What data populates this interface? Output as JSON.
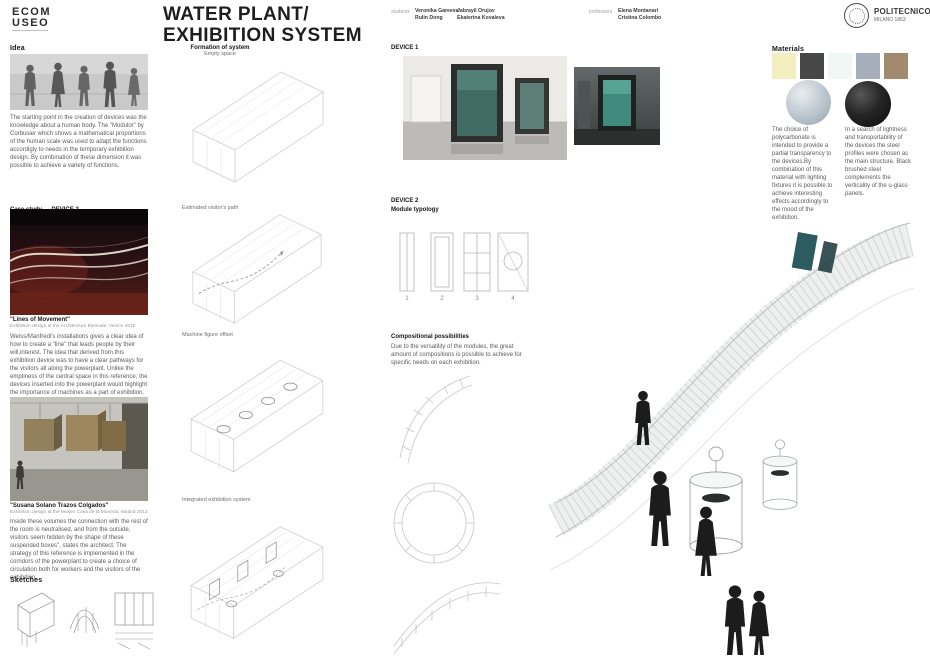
{
  "header": {
    "logo_line1": "ECOM",
    "logo_line2": "USEO",
    "title1": "WATER PLANT/",
    "title2": "EXHIBITION SYSTEM",
    "students_label": "students",
    "students": [
      "Veronika Gareeva",
      "Rulin Dong",
      "Jabrayil Orujov",
      "Ekaterina Kovaleva"
    ],
    "professors_label": "professors",
    "professors": [
      "Elena Montanari",
      "Cristina Colombo"
    ],
    "politecnico_name": "POLITECNICO",
    "politecnico_sub": "MILANO 1863"
  },
  "idea": {
    "heading": "Idea",
    "body": "The starting point in the creation of devices was the knowledge about a human body. The \"Modulor\" by Corbusier which shows a mathematical proportions of the human scale was used to adapt the functions accordigly to needs in the temporary exhibition design. By combination of these dimension it was possible to achieve a variety of functions."
  },
  "case_study": {
    "heading": "Case study",
    "heading_device": "DEVICE 2",
    "ref1_title": "\"Lines of Movement\"",
    "ref1_caption": "Exhibition design at the Architecture Biennale, Venice 2018",
    "ref1_body": "Weiss/Manfredi's installations gives a clear idea of how to create a \"line\" that leads people by their will,interest. The idea that derived from this exhibition device was to have a clear pathways for the visitors all along the powerplant. Unlike the emptiness of the central space in this reference, the devices inserted into the powerplant would highlight the importance of machines as a part of exhibition.",
    "ref2_title": "\"Susana Solano Trazos Colgados\"",
    "ref2_caption": "Exhibition design at the Museo Casa de la Moneda, Madrid 2013",
    "ref2_body": "Inside these volumes the connection with the rest of the room is neutralised, and from the outside, visitors seem hidden by the shape of these suspended boxes\", states the architect. The strategy of this reference is implemented in the corridors of the powerplant to create a choice of circulation both for workers and the visitors of the exhibition."
  },
  "sketches": {
    "heading": "Sketches"
  },
  "formation": {
    "heading": "Formation of system",
    "step1": "Empty space",
    "step2": "Estimated visitor's path",
    "step3": "Machine figure offset",
    "step4": "Integrated exhibition system"
  },
  "device1": {
    "heading": "DEVICE 1"
  },
  "device2": {
    "heading": "DEVICE 2",
    "subheading": "Module typology",
    "module_numbers": [
      "1",
      "2",
      "3",
      "4"
    ]
  },
  "compositional": {
    "heading": "Compositional possibilities",
    "body": "Due to the versatility of the modules, the great amount of compositions is possible to achieve for specific needs on each exhibition."
  },
  "materials": {
    "heading": "Materials",
    "swatches": [
      {
        "name": "polycarbonate-pale-yellow",
        "color": "#f3efbf"
      },
      {
        "name": "brushed-steel-dark-gray",
        "color": "#474747"
      },
      {
        "name": "u-glass-white",
        "color": "#f1f7f5"
      },
      {
        "name": "steel-blue-gray",
        "color": "#a6aebc"
      },
      {
        "name": "wood-tan",
        "color": "#a28a6e"
      }
    ],
    "body_left": "The choice of polycarbonate is intended to provide a partial transparency to the devices.By combination of this material with lighting fixtures it is possible to achieve interesting effects accordingly to the mood of the exhibition.",
    "body_right": "In a search of lightness and transportability of the devices the steel profiles were chosen as the main structure. Black brushed steel complements the verticality of the u-glass panels."
  }
}
